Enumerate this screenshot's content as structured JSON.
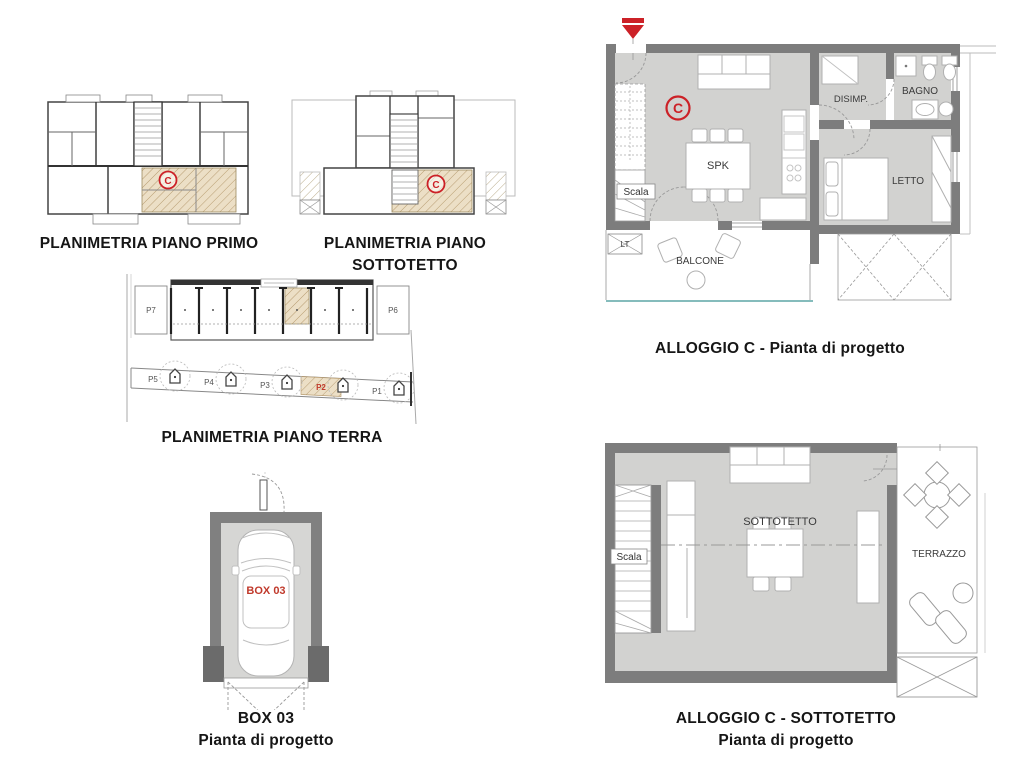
{
  "colors": {
    "wall": "#7d7d7d",
    "pier": "#6b6b6b",
    "floor": "#d2d2d0",
    "hatch_fill": "#ecdfc6",
    "hatch_line": "#b89d72",
    "accent_red": "#cc2127",
    "thin_line": "#999999",
    "teal_line": "#85bcbc"
  },
  "plans": {
    "piano_primo": {
      "caption": "PLANIMETRIA PIANO PRIMO",
      "unit_label": "C"
    },
    "piano_sottotetto": {
      "caption": "PLANIMETRIA PIANO SOTTOTETTO",
      "unit_label": "C"
    },
    "piano_terra": {
      "caption": "PLANIMETRIA PIANO TERRA",
      "left_stall": "P7",
      "right_stall": "P6",
      "parking_row": [
        "P5",
        "P4",
        "P3",
        "P2",
        "P1"
      ]
    },
    "box03": {
      "caption_line1": "BOX 03",
      "caption_line2": "Pianta di progetto",
      "box_label": "BOX 03"
    },
    "alloggio_c": {
      "caption": "ALLOGGIO C - Pianta di progetto",
      "unit_label": "C",
      "rooms": {
        "spk": "SPK",
        "disimp": "DISIMP.",
        "bagno": "BAGNO",
        "letto": "LETTO",
        "scala": "Scala",
        "lt": "LT",
        "balcone": "BALCONE"
      }
    },
    "alloggio_c_sottotetto": {
      "caption_line1": "ALLOGGIO C - SOTTOTETTO",
      "caption_line2": "Pianta di progetto",
      "rooms": {
        "sottotetto": "SOTTOTETTO",
        "terrazzo": "TERRAZZO",
        "scala": "Scala"
      }
    }
  }
}
